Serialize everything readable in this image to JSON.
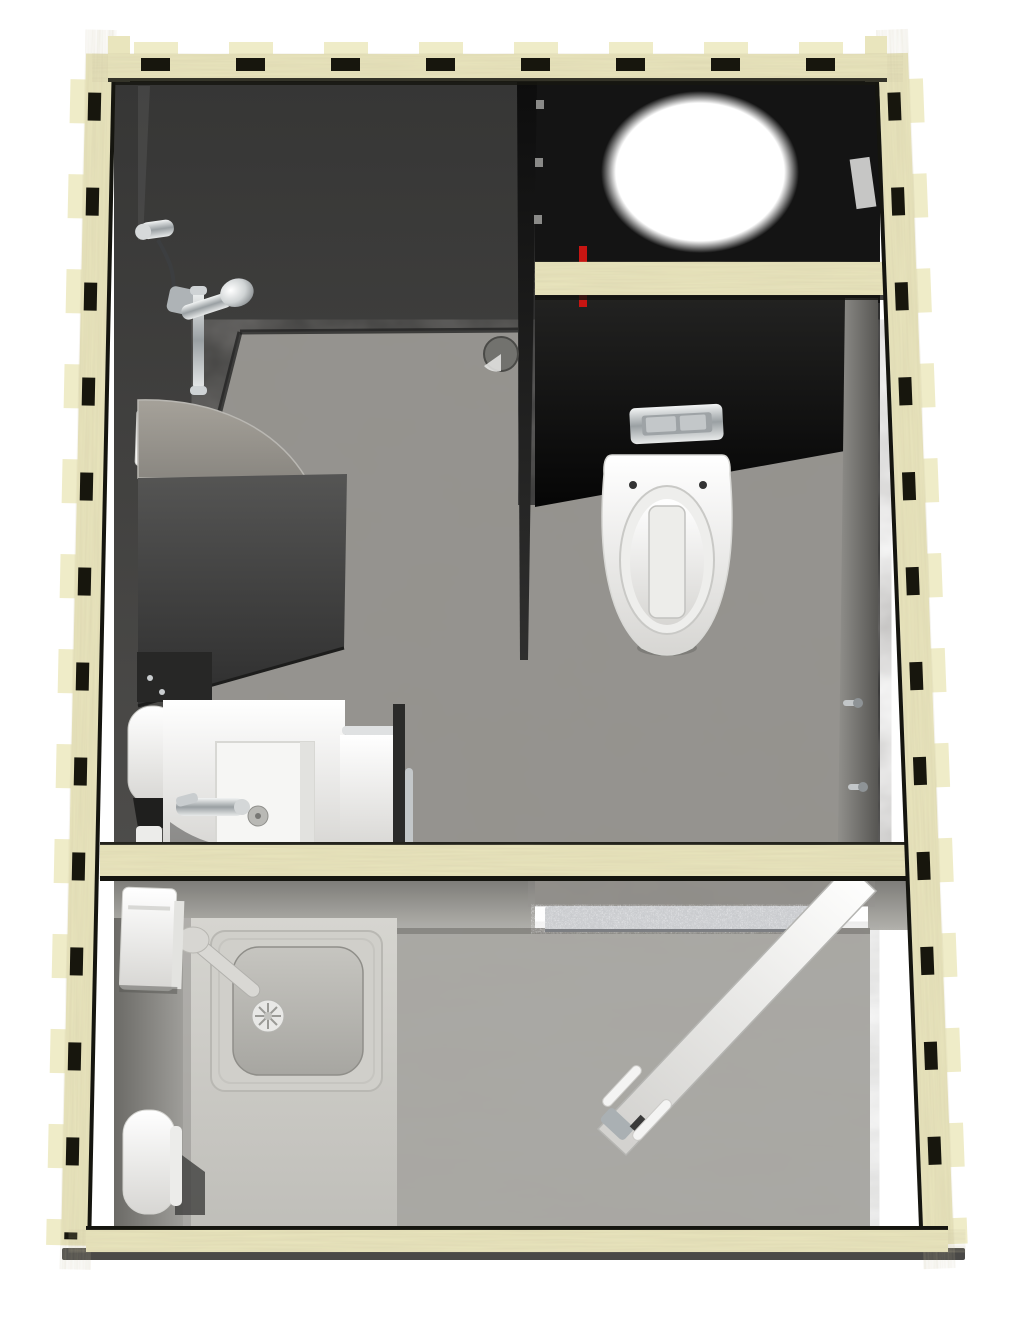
{
  "scene": {
    "description": "Top-down 3D architectural rendering of a prefabricated plywood sanitary container unit with a shower room, a WC room and a utility entry room",
    "view": "plan view, slight perspective",
    "background": "#ffffff"
  },
  "unit": {
    "construction": "cnc-cut plywood wall panels with finger-joint tabs",
    "rooms": [
      {
        "name": "shower-room",
        "fixtures": [
          "shower-wall-elbow",
          "shower-hose",
          "shower-slide-rail",
          "hand-shower-head",
          "soap-dish",
          "curved-shower-screen",
          "floor-drain",
          "fold-down-bench",
          "mirror-panel",
          "paper-roll-holder",
          "washbasin",
          "basin-mixer-tap",
          "storage-shelf",
          "towel-rail"
        ]
      },
      {
        "name": "wc-room",
        "fixtures": [
          "ceiling-opening",
          "service-beam",
          "red-supply-pipe",
          "flush-plate",
          "wall-hung-toilet",
          "coat-hook-upper",
          "coat-hook-lower",
          "wall-light-sliver"
        ]
      },
      {
        "name": "utility-entry-room",
        "fixtures": [
          "dividing-beam",
          "door-step",
          "counter",
          "inset-square-sink",
          "sink-drain",
          "sink-tap",
          "electric-panel-box",
          "water-heater",
          "entrance-door",
          "door-handle-set"
        ]
      }
    ]
  },
  "colors": {
    "background": "#ffffff",
    "wood": "#e9e5bd",
    "wood_tab": "#efecc8",
    "notch": "#17160d",
    "trim": "#15150f",
    "ground": "#4a4947",
    "wall_face_top": "#363635",
    "wall_face_bottom": "#4d4c4a",
    "ceiling_black": "#141414",
    "panel_top": "#222221",
    "panel_bottom": "#050505",
    "partition_top": "#0d0d0d",
    "partition_bottom": "#2f2f2e",
    "stone_floor": "#95938e",
    "concrete_floor": "#a9a7a2",
    "counter_top": "#d6d5d0",
    "counter_bottom": "#bfbeb9",
    "rear_top": "#7b7a76",
    "rear_bottom": "#b2b1ac",
    "screen_top": "#a6a29a",
    "screen_bottom": "#8a8781",
    "bench_top": "#555554",
    "bench_bottom": "#2f2f2f",
    "white": "#ffffff",
    "white_shade": "#d7d6d3",
    "door_light": "#fdfdfc",
    "door_shade": "#d3d2cf",
    "chrome_light": "#f2f4f4",
    "chrome_mid": "#9aa0a3",
    "red_pipe": "#c81512",
    "step": "#c6c8cb",
    "reveal": "#8f8d88",
    "right_face_light": "#8e8d89",
    "right_face_dark": "#545350",
    "basin_in_top": "#c6c5c0",
    "basin_in_bottom": "#a7a6a1",
    "sink_frame": "#d0cfca",
    "light_sliver": "#d9d9d8"
  }
}
